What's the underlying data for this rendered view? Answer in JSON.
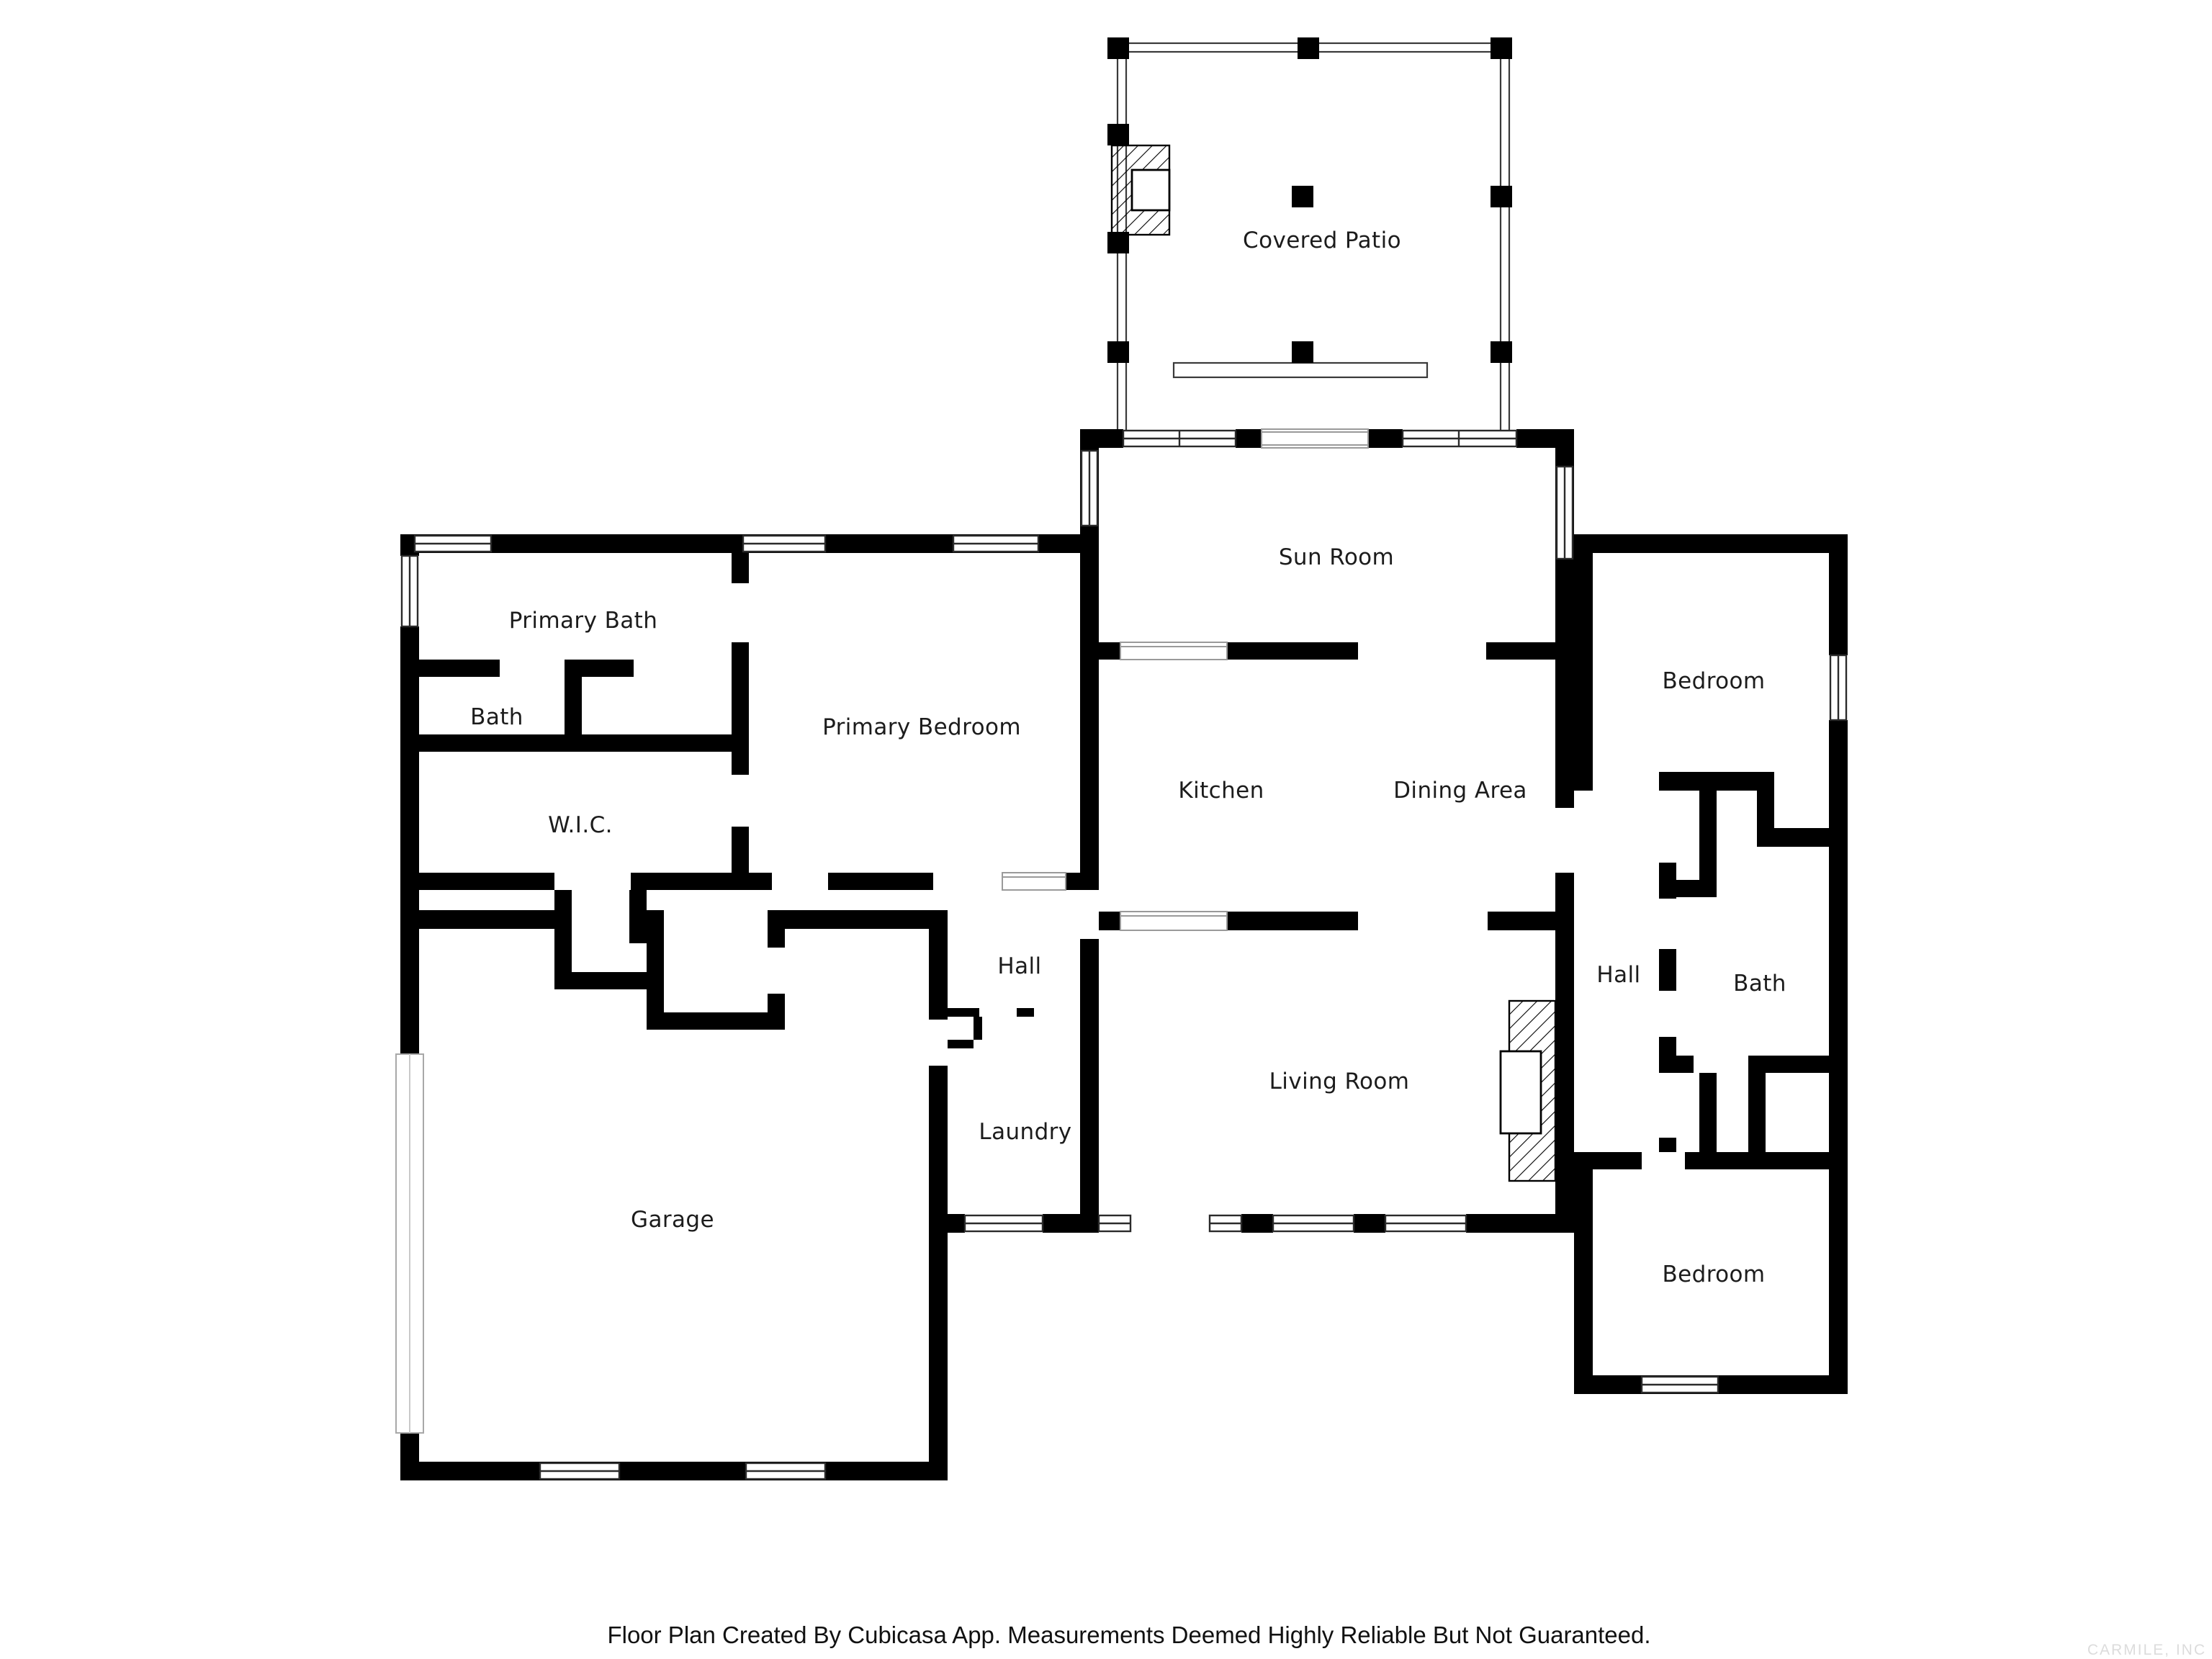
{
  "page": {
    "background": "#ffffff"
  },
  "colors": {
    "wall": "#000000",
    "label": "#1c1c1c",
    "window_frame": "#2b2b2b",
    "patio_outline": "#3a3a3a",
    "opening_line": "#9a9a9a",
    "footer": "#111111",
    "watermark": "#dcdcdc"
  },
  "rooms": {
    "covered_patio": {
      "label": "Covered Patio"
    },
    "sun_room": {
      "label": "Sun Room"
    },
    "primary_bath": {
      "label": "Primary Bath"
    },
    "bath": {
      "label": "Bath"
    },
    "wic": {
      "label": "W.I.C."
    },
    "primary_bedroom": {
      "label": "Primary Bedroom"
    },
    "kitchen": {
      "label": "Kitchen"
    },
    "dining_area": {
      "label": "Dining Area"
    },
    "bedroom_ne": {
      "label": "Bedroom"
    },
    "hall_east": {
      "label": "Hall"
    },
    "bath_east": {
      "label": "Bath"
    },
    "bedroom_se": {
      "label": "Bedroom"
    },
    "hall_center": {
      "label": "Hall"
    },
    "laundry": {
      "label": "Laundry"
    },
    "living_room": {
      "label": "Living Room"
    },
    "garage": {
      "label": "Garage"
    }
  },
  "footer": {
    "text": "Floor Plan Created By Cubicasa App. Measurements Deemed Highly Reliable But Not Guaranteed."
  },
  "watermark": {
    "text": "CARMILE, INC"
  }
}
